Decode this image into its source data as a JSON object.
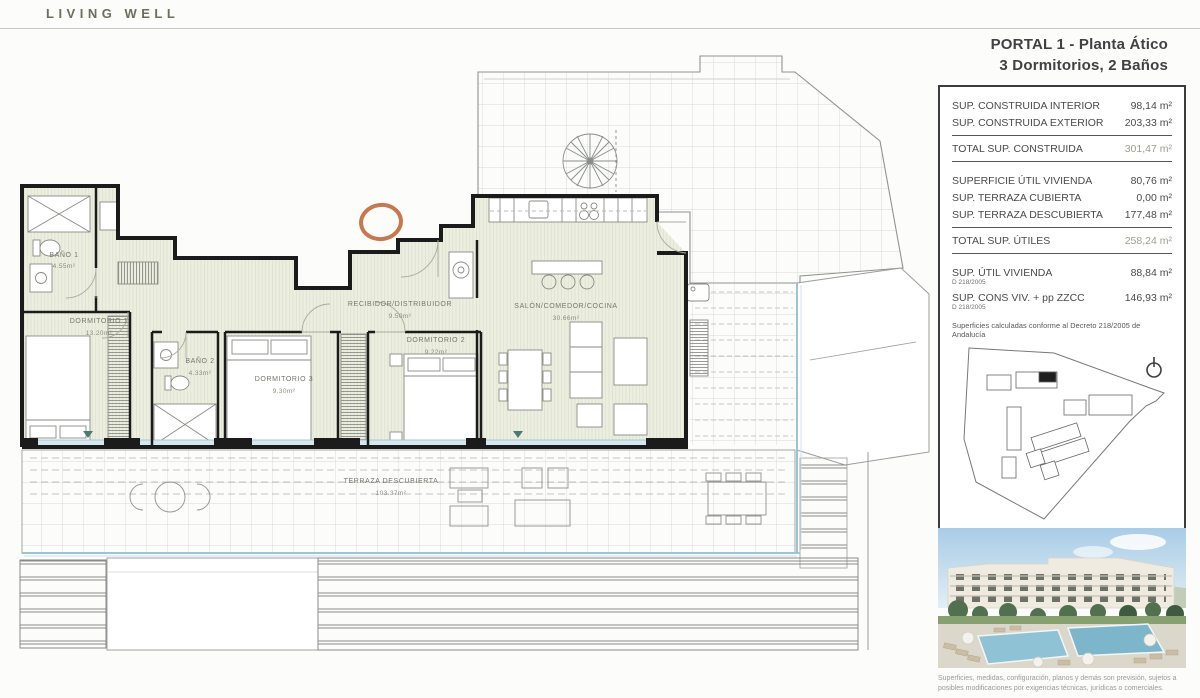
{
  "logo": "LIVING WELL",
  "header": {
    "line1": "PORTAL 1 - Planta Ático",
    "line2": "3 Dormitorios, 2 Baños"
  },
  "summary": {
    "construida": {
      "rows": [
        {
          "label": "SUP. CONSTRUIDA INTERIOR",
          "value": "98,14 m²"
        },
        {
          "label": "SUP. CONSTRUIDA EXTERIOR",
          "value": "203,33 m²"
        }
      ],
      "total": {
        "label": "TOTAL SUP. CONSTRUIDA",
        "value": "301,47 m²"
      }
    },
    "utiles": {
      "rows": [
        {
          "label": "SUPERFICIE ÚTIL VIVIENDA",
          "value": "80,76 m²"
        },
        {
          "label": "SUP. TERRAZA CUBIERTA",
          "value": "0,00 m²"
        },
        {
          "label": "SUP. TERRAZA DESCUBIERTA",
          "value": "177,48 m²"
        }
      ],
      "total": {
        "label": "TOTAL SUP. ÚTILES",
        "value": "258,24 m²"
      }
    },
    "decreto": {
      "rows": [
        {
          "label": "SUP. ÚTIL VIVIENDA",
          "sub": "D 218/2005",
          "value": "88,84 m²"
        },
        {
          "label": "SUP. CONS VIV. + pp ZZCC",
          "sub": "D 218/2005",
          "value": "146,93 m²"
        }
      ],
      "note": "Superficies calculadas conforme al Decreto 218/2005 de Andalucía"
    }
  },
  "plan": {
    "rooms": [
      {
        "name": "BAÑO 1",
        "area": "4.55m²"
      },
      {
        "name": "DORMITORIO 1",
        "area": "13.20m²"
      },
      {
        "name": "BAÑO 2",
        "area": "4.33m²"
      },
      {
        "name": "DORMITORIO 3",
        "area": "9.30m²"
      },
      {
        "name": "RECIBIDOR/DISTRIBUIDOR",
        "area": "9.50m²"
      },
      {
        "name": "DORMITORIO 2",
        "area": "9.22m²"
      },
      {
        "name": "SALÓN/COMEDOR/COCINA",
        "area": "30.66m²"
      },
      {
        "name": "TERRAZA DESCUBIERTA",
        "area": "103.37m²"
      }
    ]
  },
  "disclaimer": "Superficies, medidas, configuración, planos y demás son previsión, sujetos a posibles modificaciones por exigencias técnicas, jurídicas o comerciales.",
  "colors": {
    "accent_orange": "#c8784e",
    "balustrade_blue": "#9ec4d2",
    "floor_sage": "#ecefe0",
    "wall": "#1b1b1b",
    "total_value": "#9aa08f",
    "marker_teal": "#4e7a6e"
  }
}
